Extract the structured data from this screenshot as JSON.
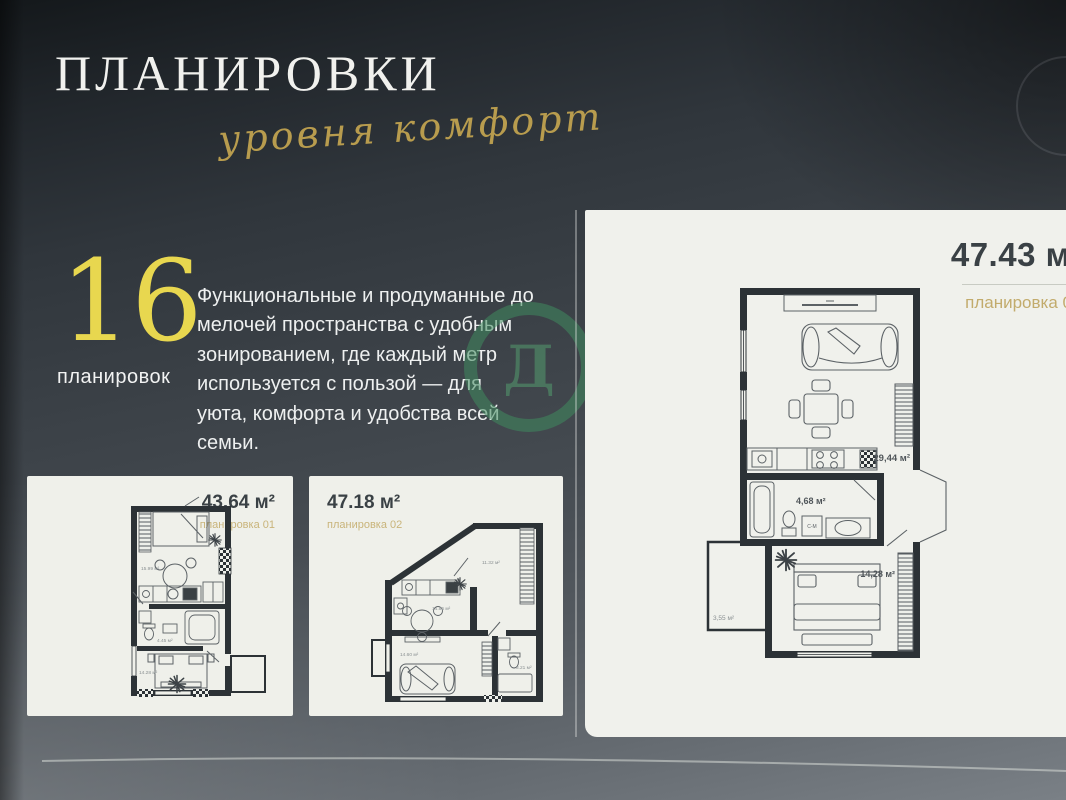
{
  "page": {
    "title": "ПЛАНИРОВКИ",
    "tagline": "уровня комфорт",
    "stat_number": "16",
    "stat_label": "планировок",
    "intro": "Функциональные и продуманные до мелочей пространства с удобным зонированием, где каждый метр используется с пользой — для уюта, комфорта и удобства всей семьи.",
    "watermark_letter": "Д"
  },
  "featured_plan": {
    "area": "47.43 м²",
    "plan_label": "планировка 0",
    "living_area": "29,44 м²",
    "bath_area": "4,68 м²",
    "bedroom_area": "14,28 м²",
    "balcony_area": "3,55 м²",
    "washer_label": "С-М"
  },
  "plan_cards": [
    {
      "area": "43.64 м²",
      "plan_label": "планировка 01",
      "living_area": "15.99 м²",
      "bath_area": "4.45 м²",
      "bedroom_area": "14.28 м²"
    },
    {
      "area": "47.18 м²",
      "plan_label": "планировка 02",
      "kitchen_area": "14.86 м²",
      "hall_area": "11.32 м²",
      "bedroom_area": "14.60 м²",
      "bath_area": "3.21 м²"
    }
  ],
  "colors": {
    "background_dark": "#2f353b",
    "gold_accent": "#b89c4e",
    "stat_yellow": "#e8d74f",
    "panel_paper": "#f0f1ec",
    "ink": "#3a4145",
    "plan_wall": "#2c3236",
    "watermark_green": "#408a5e"
  }
}
